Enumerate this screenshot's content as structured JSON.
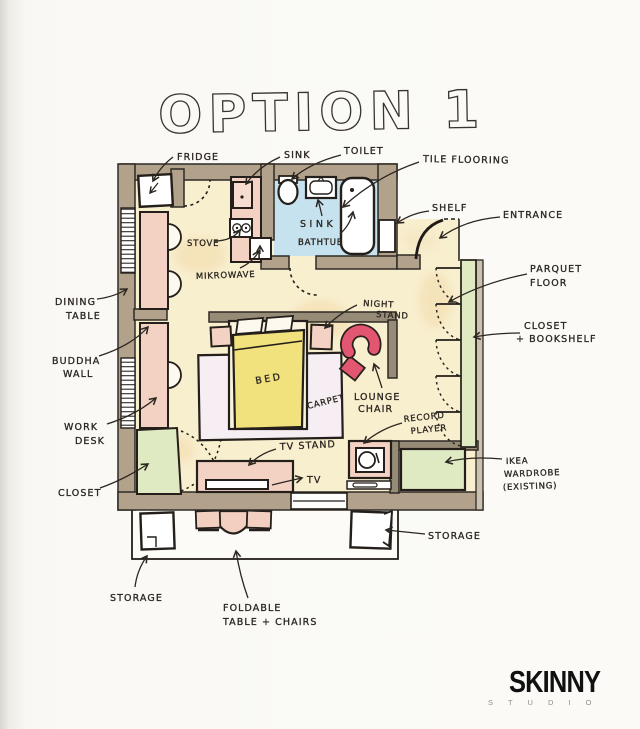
{
  "title": "OPTION 1",
  "logo": {
    "brand": "SKINNY",
    "sub": "S T U D I O"
  },
  "labels": {
    "fridge": [
      "FRIDGE"
    ],
    "sink_kitchen": [
      "SINK"
    ],
    "toilet": [
      "TOILET"
    ],
    "tile_flooring": [
      "TILE FLOORING"
    ],
    "shelf": [
      "SHELF"
    ],
    "entrance": [
      "ENTRANCE"
    ],
    "parquet_floor": [
      "PARQUET",
      "FLOOR"
    ],
    "closet_bookshelf": [
      "CLOSET",
      "+ BOOKSHELF"
    ],
    "dining_table": [
      "DINING",
      "TABLE"
    ],
    "buddha_wall": [
      "BUDDHA",
      "WALL"
    ],
    "work_desk": [
      "WORK",
      "DESK"
    ],
    "closet": [
      "CLOSET"
    ],
    "stove": [
      "STOVE"
    ],
    "mikrowave": [
      "MIKROWAVE"
    ],
    "sink_bath": [
      "SINK"
    ],
    "bathtub": [
      "BATHTUB"
    ],
    "night_stand": [
      "NIGHT",
      "STAND"
    ],
    "bed": [
      "BED"
    ],
    "carpet": [
      "CARPET"
    ],
    "lounge_chair": [
      "LOUNGE",
      "CHAIR"
    ],
    "record_player": [
      "RECORD",
      "PLAYER"
    ],
    "tv_stand": [
      "TV STAND"
    ],
    "tv": [
      "TV"
    ],
    "ikea_wardrobe": [
      "IKEA",
      "WARDROBE",
      "(EXISTING)"
    ],
    "storage_left": [
      "STORAGE"
    ],
    "storage_right": [
      "STORAGE"
    ],
    "foldable_table": [
      "FOLDABLE",
      "TABLE + CHAIRS"
    ]
  },
  "colors": {
    "paper": "#faf9f5",
    "wall_tan": "#b2a28b",
    "inner_wall": "#968b76",
    "floor_cream": "#f8efcf",
    "bath_blue": "#c6e2ee",
    "furniture_pink": "#f3d2c3",
    "closet_green": "#dfe9c2",
    "bed_yellow": "#f2e27d",
    "carpet": "#f6eef3",
    "lounge_red": "#e25672",
    "ink": "#2b2620"
  }
}
